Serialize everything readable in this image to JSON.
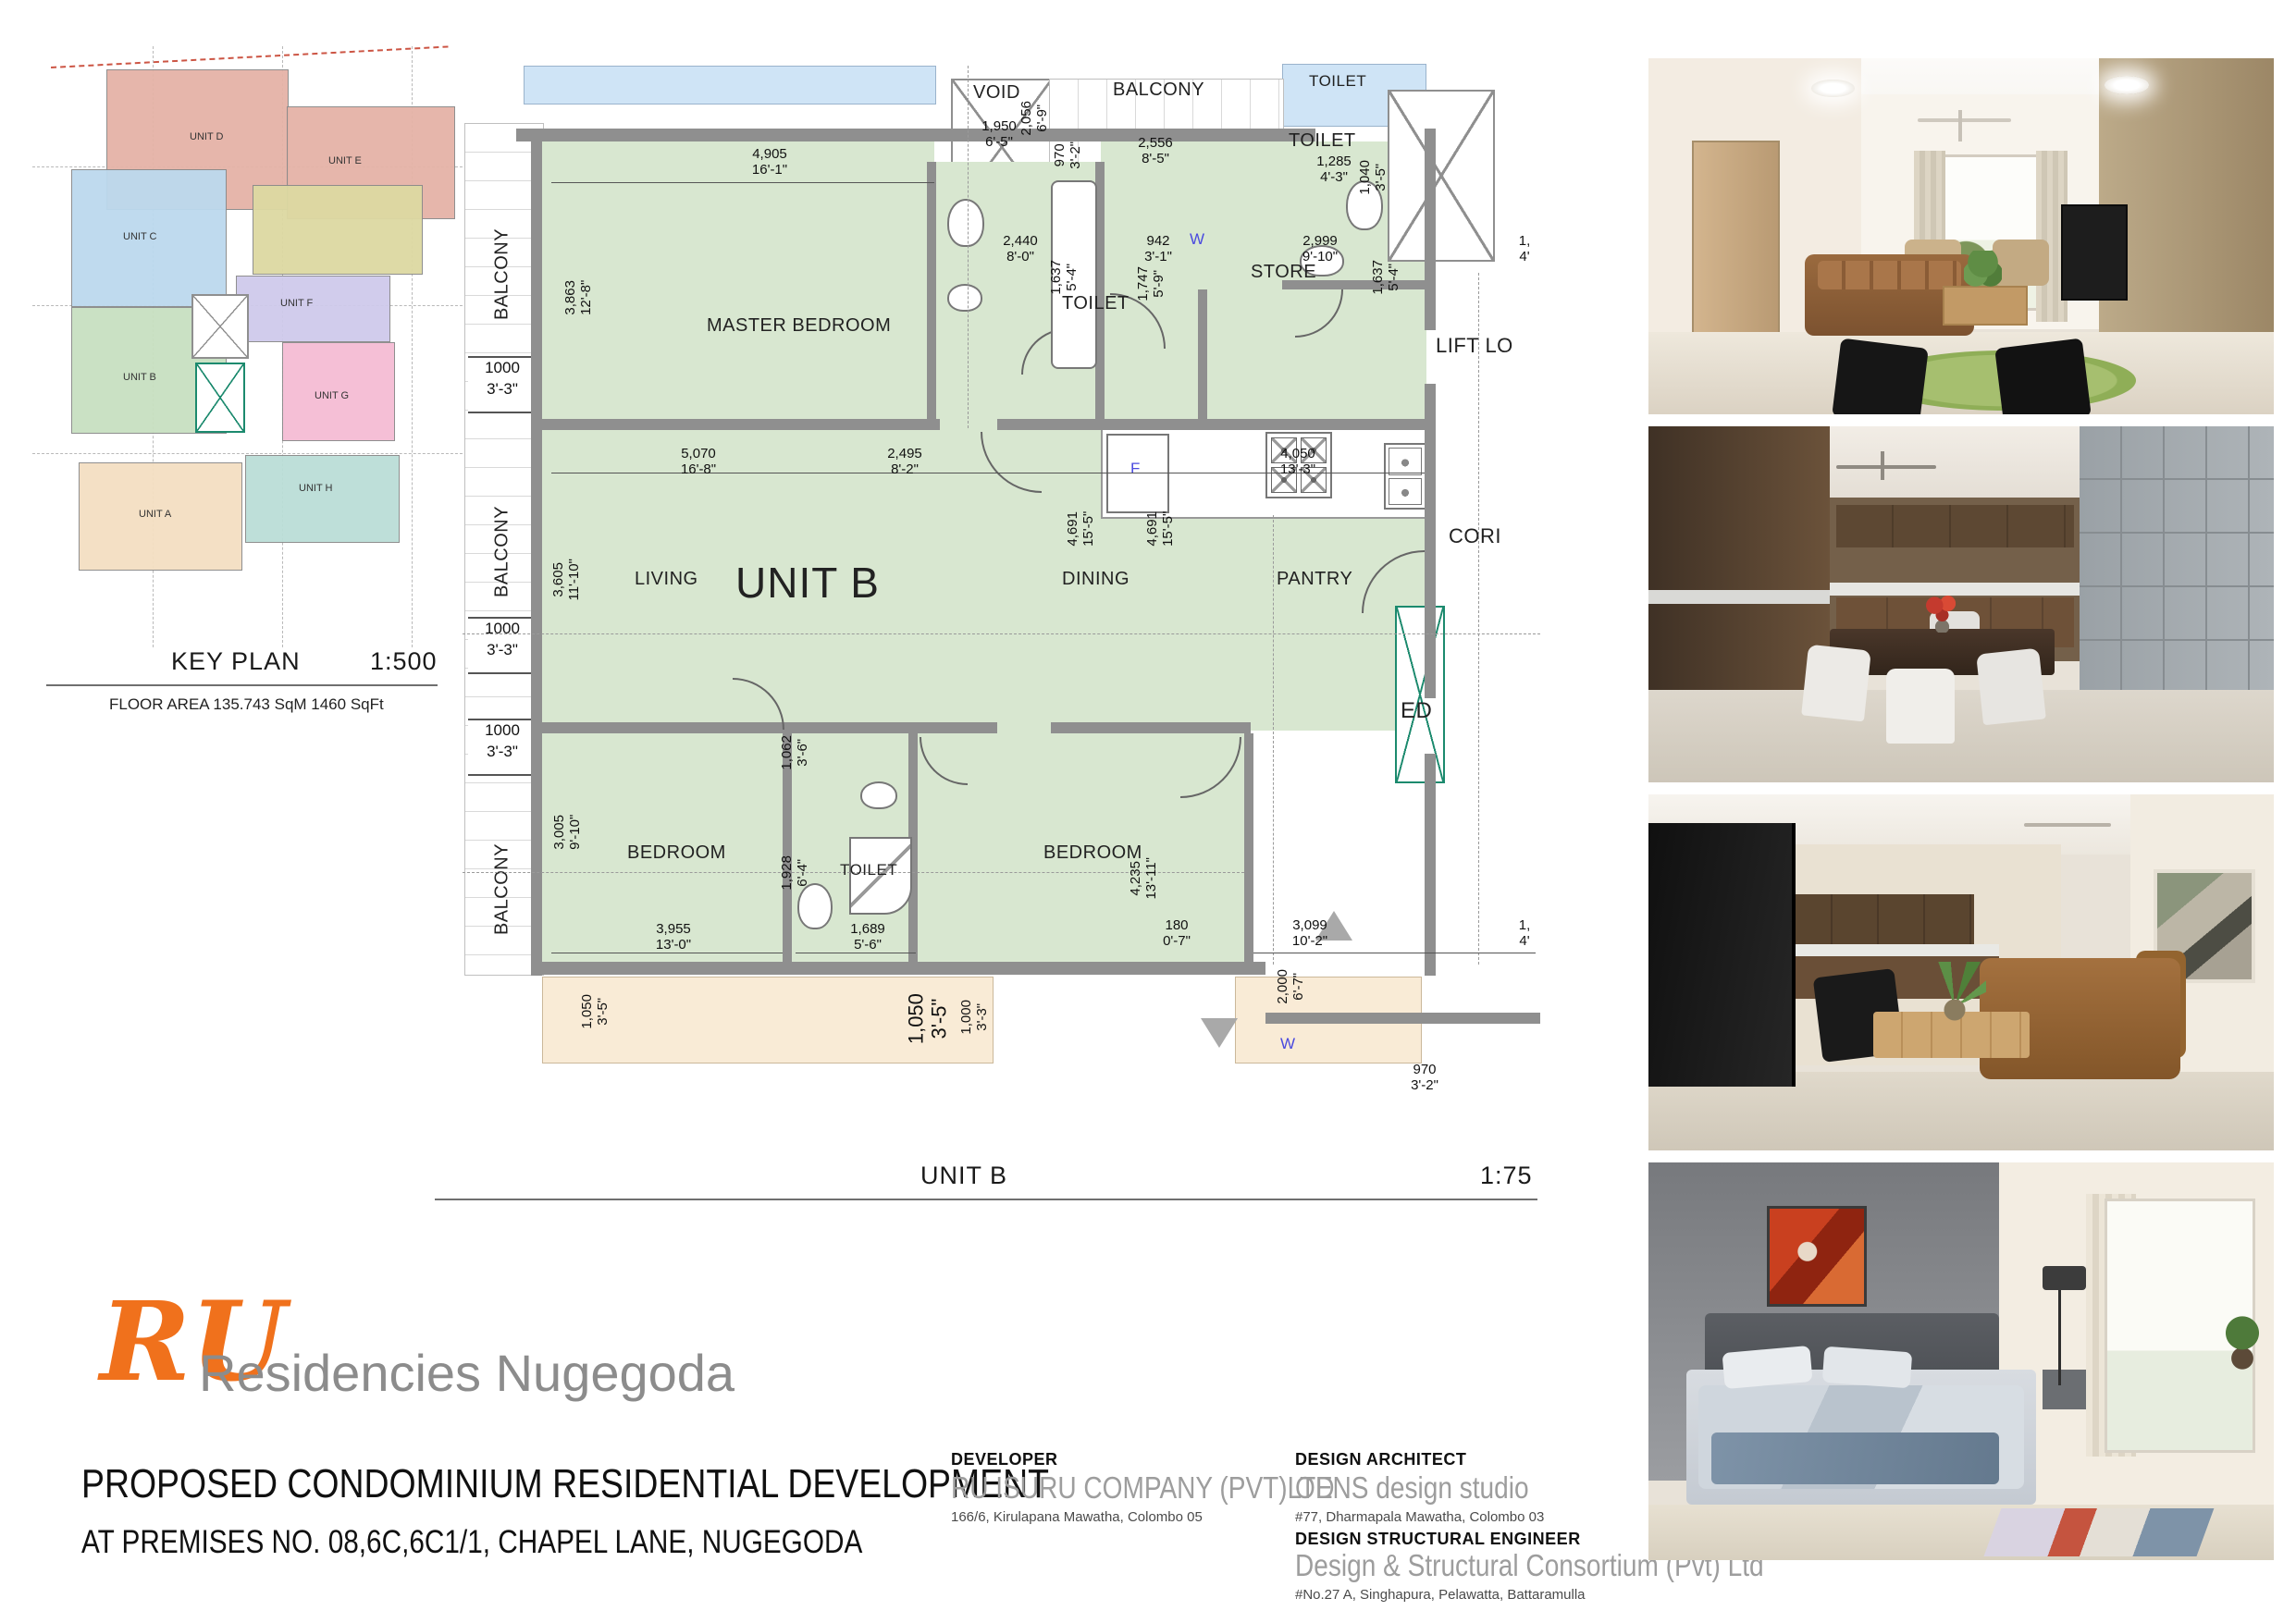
{
  "colors": {
    "accent-orange": "#F0711C",
    "brand-gray": "#8C8C8C",
    "plan-green": "#D8E7D0",
    "plan-blue": "#CFE4F6",
    "plan-tan": "#F9EBD6",
    "wall-gray": "#8F8F8F",
    "unit-d": "#E5B3A7",
    "unit-e": "#DDD9A2",
    "unit-c": "#BCD9EE",
    "unit-f": "#CFCAEB",
    "unit-b": "#C8E0C1",
    "unit-g": "#F5BCD4",
    "unit-a": "#F4DFC2",
    "unit-h": "#BBDED7"
  },
  "key_plan": {
    "title": "KEY PLAN",
    "scale": "1:500",
    "floor_area": "FLOOR AREA 135.743 SqM  1460 SqFt",
    "units": [
      {
        "label": "UNIT D"
      },
      {
        "label": "UNIT E"
      },
      {
        "label": "UNIT C"
      },
      {
        "label": "UNIT F"
      },
      {
        "label": "UNIT B"
      },
      {
        "label": "UNIT G"
      },
      {
        "label": "UNIT A"
      },
      {
        "label": "UNIT H"
      }
    ]
  },
  "plan": {
    "caption": "UNIT B",
    "scale": "1:75",
    "rooms": {
      "master": "MASTER BEDROOM",
      "living": "LIVING",
      "unit": "UNIT B",
      "dining": "DINING",
      "pantry": "PANTRY",
      "store": "STORE",
      "toilet_master": "TOILET",
      "toilet_upper": "TOILET",
      "toilet_adjacent": "TOILET",
      "toilet_bottom": "TOILET",
      "bedroom_left": "BEDROOM",
      "bedroom_right": "BEDROOM",
      "balcony": "BALCONY",
      "void": "VOID",
      "lift": "LIFT LO",
      "corridor": "CORI",
      "ed": "ED",
      "fridge": "F",
      "washer": "W"
    },
    "dims": [
      {
        "mm": "4,905",
        "ft": "16'-1\""
      },
      {
        "mm": "3,863",
        "ft": "12'-8\""
      },
      {
        "mm": "1,950",
        "ft": "6'-5\""
      },
      {
        "mm": "2,056",
        "ft": "6'-9\""
      },
      {
        "mm": "970",
        "ft": "3'-2\""
      },
      {
        "mm": "2,556",
        "ft": "8'-5\""
      },
      {
        "mm": "1,285",
        "ft": "4'-3\""
      },
      {
        "mm": "1,040",
        "ft": "3'-5\""
      },
      {
        "mm": "2,440",
        "ft": "8'-0\""
      },
      {
        "mm": "1,637",
        "ft": "5'-4\""
      },
      {
        "mm": "942",
        "ft": "3'-1\""
      },
      {
        "mm": "1,747",
        "ft": "5'-9\""
      },
      {
        "mm": "2,999",
        "ft": "9'-10\""
      },
      {
        "mm": "1,637",
        "ft": "5'-4\""
      },
      {
        "mm": "5,070",
        "ft": "16'-8\""
      },
      {
        "mm": "2,495",
        "ft": "8'-2\""
      },
      {
        "mm": "4,050",
        "ft": "13'-3\""
      },
      {
        "mm": "3,605",
        "ft": "11'-10\""
      },
      {
        "mm": "4,691",
        "ft": "15'-5\""
      },
      {
        "mm": "4,691",
        "ft": "15'-5\""
      },
      {
        "mm": "1000",
        "ft": "3'-3\""
      },
      {
        "mm": "1000",
        "ft": "3'-3\""
      },
      {
        "mm": "1000",
        "ft": "3'-3\""
      },
      {
        "mm": "3,005",
        "ft": "9'-10\""
      },
      {
        "mm": "3,955",
        "ft": "13'-0\""
      },
      {
        "mm": "1,062",
        "ft": "3'-6\""
      },
      {
        "mm": "1,928",
        "ft": "6'-4\""
      },
      {
        "mm": "1,689",
        "ft": "5'-6\""
      },
      {
        "mm": "4,235",
        "ft": "13'-11\""
      },
      {
        "mm": "180",
        "ft": "0'-7\""
      },
      {
        "mm": "3,099",
        "ft": "10'-2\""
      },
      {
        "mm": "2,000",
        "ft": "6'-7\""
      },
      {
        "mm": "1,050",
        "ft": "3'-5\""
      },
      {
        "mm": "1,050",
        "ft": "3'-5\""
      },
      {
        "mm": "1,000",
        "ft": "3'-3\""
      },
      {
        "mm": "970",
        "ft": "3'-2\""
      },
      {
        "mm": "1,",
        "ft": "4'"
      },
      {
        "mm": "1,",
        "ft": "4'"
      }
    ]
  },
  "branding": {
    "logo": "RU",
    "name": "Residencies Nugegoda"
  },
  "project": {
    "title": "PROPOSED CONDOMINIUM RESIDENTIAL DEVELOPMENT",
    "address_line": "AT  PREMISES  NO. 08,6C,6C1/1, CHAPEL LANE, NUGEGODA"
  },
  "parties": {
    "developer": {
      "heading": "DEVELOPER",
      "name": "RU ISURU COMPANY (PVT)LTD",
      "address": "166/6, Kirulapana Mawatha, Colombo 05"
    },
    "architect": {
      "heading": "DESIGN ARCHITECT",
      "name": "OENS design studio",
      "address": "#77, Dharmapala Mawatha, Colombo 03"
    },
    "engineer": {
      "heading": "DESIGN STRUCTURAL ENGINEER",
      "name": "Design & Structural Consortium (Pvt) Ltd",
      "address": "#No.27 A, Singhapura, Pelawatta, Battaramulla"
    }
  }
}
